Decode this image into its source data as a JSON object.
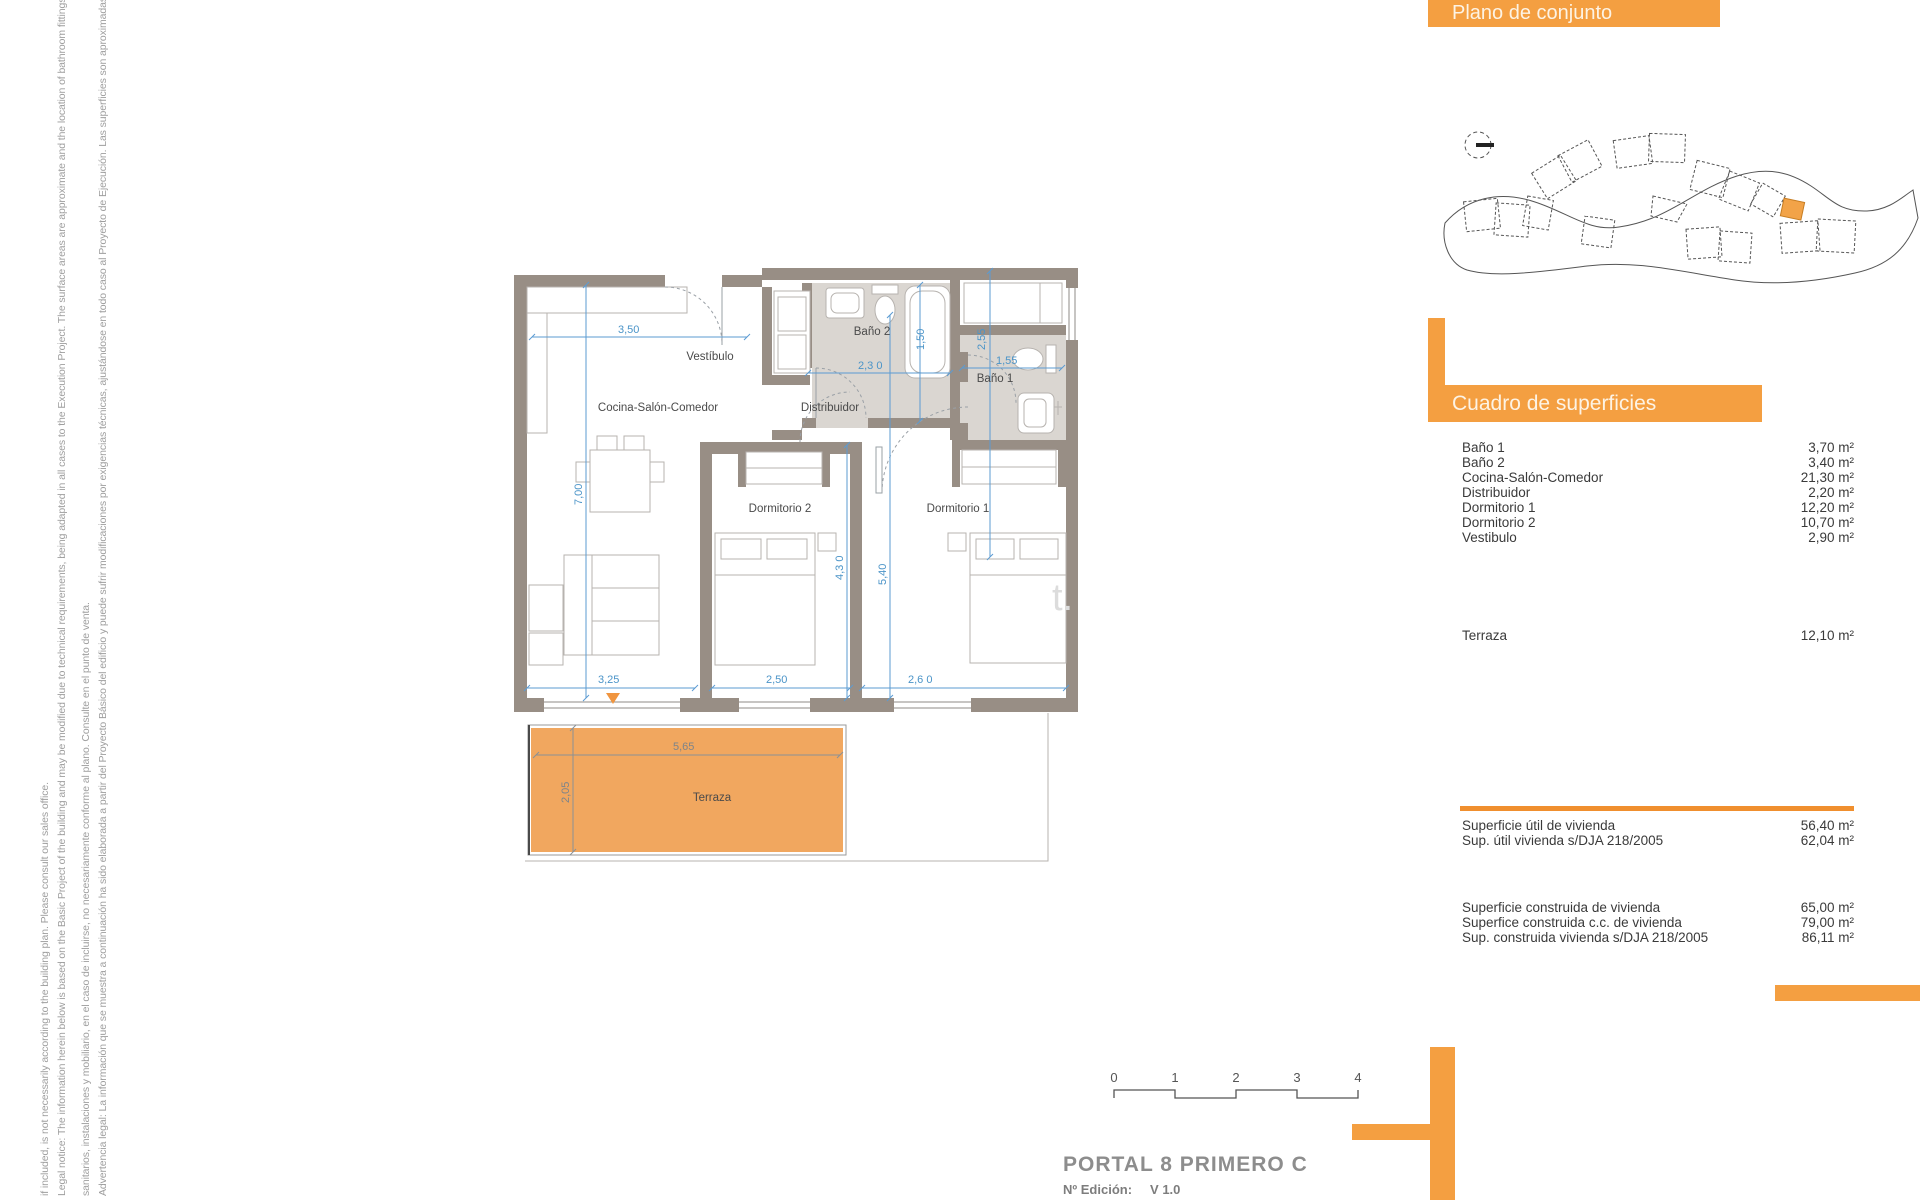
{
  "legal": {
    "en_line2": "if included, is not necessarily according to the building plan. Please consult our sales office.",
    "en_line1": "Legal notice: The information herein below is based on the Basic Project of the building and may be modified due to technical requirements, being adapted in all cases to the Execution Project. The surface areas are approximate and the location of bathroom fittings, facilities and furniture,",
    "es_line2": "sanitarios, instalaciones y mobiliario, en el caso de incluirse, no necesariamente conforme al plano. Consulte en el punto de venta.",
    "es_line1": "Advertencia legal: La información que se muestra a continuación ha sido elaborada a partir del Proyecto Básico del edificio y puede sufrir modificaciones por exigencias técnicas, ajustándose en todo caso al Proyecto de Ejecución. Las superficies son aproximadas y la ubicación de aparatos"
  },
  "site_plan": {
    "title": "Plano de conjunto"
  },
  "surfaces": {
    "title": "Cuadro de superficies",
    "rows": [
      {
        "label": "Baño 1",
        "value": "3,70 m²"
      },
      {
        "label": "Baño 2",
        "value": "3,40 m²"
      },
      {
        "label": "Cocina-Salón-Comedor",
        "value": "21,30 m²"
      },
      {
        "label": "Distribuidor",
        "value": "2,20 m²"
      },
      {
        "label": "Dormitorio 1",
        "value": "12,20 m²"
      },
      {
        "label": "Dormitorio 2",
        "value": "10,70 m²"
      },
      {
        "label": "Vestibulo",
        "value": "2,90 m²"
      }
    ],
    "terrace_row": {
      "label": "Terraza",
      "value": "12,10 m²"
    },
    "useful": [
      {
        "label": "Superficie útil de vivienda",
        "value": "56,40 m²"
      },
      {
        "label": "Sup. útil vivienda s/DJA 218/2005",
        "value": "62,04 m²"
      }
    ],
    "built": [
      {
        "label": "Superficie construida de vivienda",
        "value": "65,00 m²"
      },
      {
        "label": "Superfice construida c.c. de vivienda",
        "value": "79,00 m²"
      },
      {
        "label": "Sup. construida vivienda s/DJA 218/2005",
        "value": "86,11 m²"
      }
    ]
  },
  "plan": {
    "rooms": {
      "vestibulo": "Vestíbulo",
      "cocina": "Cocina-Salón-Comedor",
      "bano2": "Baño 2",
      "bano1": "Baño 1",
      "distribuidor": "Distribuidor",
      "dorm2": "Dormitorio 2",
      "dorm1": "Dormitorio 1",
      "terraza": "Terraza"
    },
    "dims": {
      "w350": "3,50",
      "w230": "2,3 0",
      "w150": "1,50",
      "w255": "2,55",
      "w155": "1,55",
      "w700": "7,00",
      "w430": "4,3 0",
      "w540": "5,40",
      "w325": "3,25",
      "w250": "2,50",
      "w260": "2,6 0",
      "t565": "5,65",
      "t205": "2,05"
    },
    "watermark": "t."
  },
  "footer": {
    "title": "PORTAL 8 PRIMERO C",
    "edition_label": "Nº Edición:",
    "edition_value": "V 1.0",
    "scale_ticks": [
      "0",
      "1",
      "2",
      "3",
      "4"
    ]
  },
  "colors": {
    "accent_orange": "#f49f41",
    "terrace_orange": "#f1a75f",
    "wall_taupe": "#988e85",
    "bath_floor": "#dad6d1",
    "dimension_blue": "#5b9bd2",
    "footer_gray": "#8d8d8d",
    "legal_gray": "#9e9e9e"
  }
}
